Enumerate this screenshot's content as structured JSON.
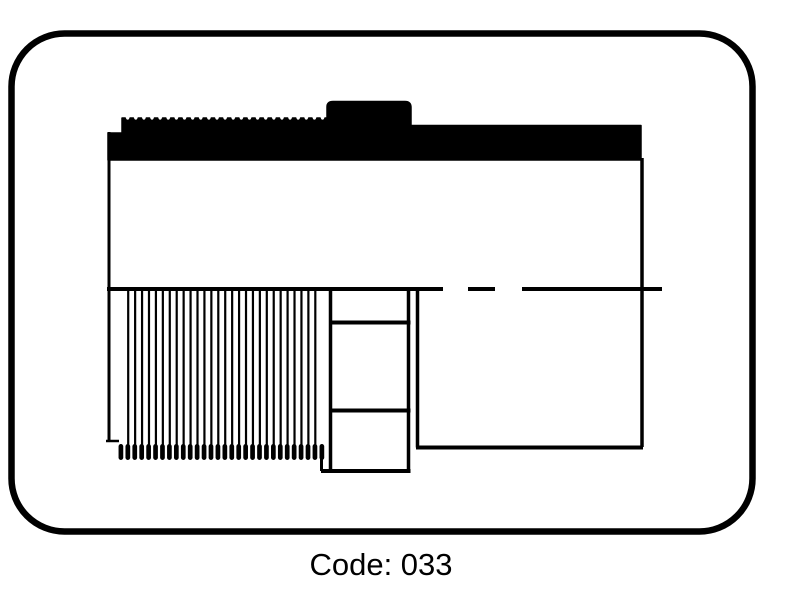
{
  "figure": {
    "caption": "Code: 033",
    "code_value": "033",
    "diagram_name": "male-threaded-adapter-pipe-fitting-half-section-diagram",
    "colors": {
      "ink": "#000000",
      "paper": "#ffffff"
    }
  }
}
